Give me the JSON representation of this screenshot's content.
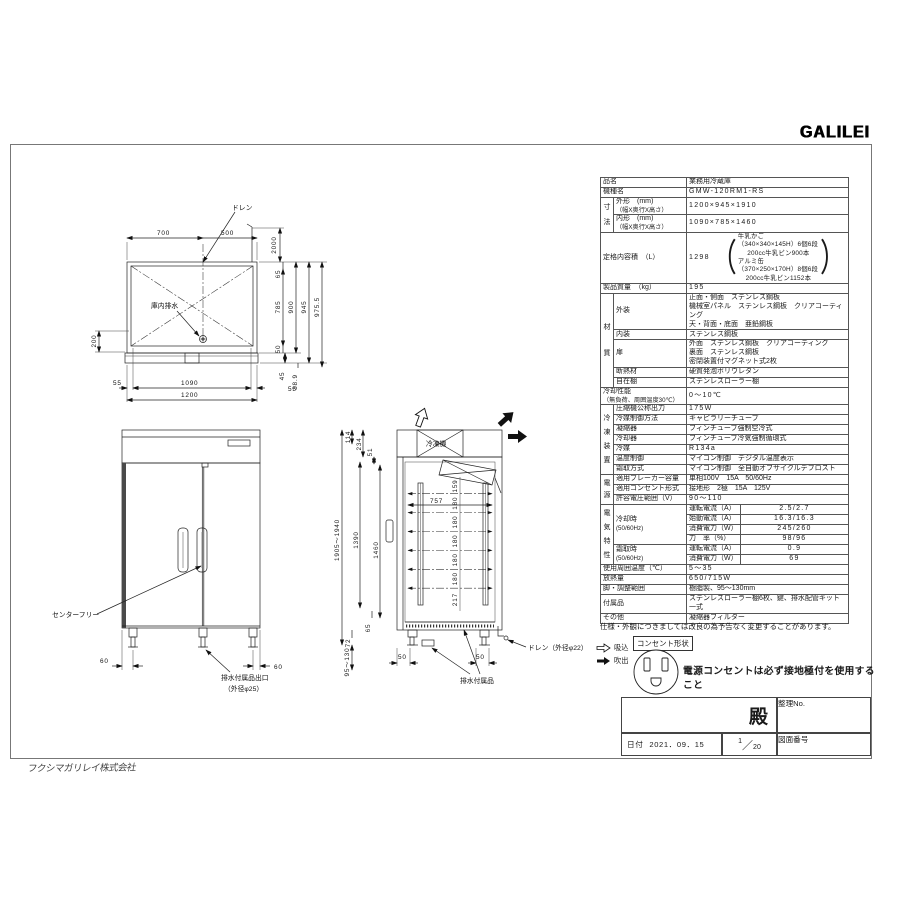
{
  "brand": {
    "logo": "GALILEI",
    "watermark": "フクシマガリレイ株式会社"
  },
  "spec": {
    "secs": {
      "sunpo": "寸\n法",
      "zai": "材\n質",
      "reito": "冷\n凍\n装\n置",
      "dengen": "電\n源",
      "denki": "電\n気\n特\n性"
    },
    "hinmei": {
      "l": "品名",
      "v": "業務用冷蔵庫"
    },
    "kishu": {
      "l": "機種名",
      "v": "GMW-120RM1-RS"
    },
    "gaikei": {
      "l": "外形　(mm)",
      "l2": "（幅X奥行X高さ）",
      "v": "1200×945×1910"
    },
    "naikei": {
      "l": "内形　(mm)",
      "l2": "（幅X奥行X高さ）",
      "v": "1090×785×1460"
    },
    "naiyoseki": {
      "l": "定格内容積　（L）",
      "v": "1298",
      "n1": "牛乳かご（340×340×145H）6個6段",
      "n2": "200cc牛乳ビン900本",
      "n3": "アルミ缶（370×250×170H）8個6段",
      "n4": "200cc牛乳ビン1152本"
    },
    "mass": {
      "l": "製品質量　（kg）",
      "v": "195"
    },
    "gaiso": {
      "l": "外装",
      "v1": "正面・側面　ステンレス鋼板",
      "v2": "機械室パネル　ステンレス鋼板　クリアコーティング",
      "v3": "天・背面・底面　亜鉛鋼板"
    },
    "naiso": {
      "l": "内装",
      "v": "ステンレス鋼板"
    },
    "tobira": {
      "l": "扉",
      "v1": "外面　ステンレス鋼板　クリアコーティング",
      "v2": "裏面　ステンレス鋼板",
      "v3": "密閉装置付マグネット式2枚"
    },
    "dannetsu": {
      "l": "断熱材",
      "v": "硬質発泡ポリウレタン"
    },
    "jizai": {
      "l": "自在棚",
      "v": "ステンレスローラー棚"
    },
    "reikyaku": {
      "l": "冷却性能",
      "l2": "（無負荷、周囲温度30℃）",
      "v": "0～10℃"
    },
    "asshuku": {
      "l": "圧縮機公称出力",
      "v": "175W"
    },
    "reibaiseigyo": {
      "l": "冷媒制御方法",
      "v": "キャピラリーチューブ"
    },
    "gyoshuku": {
      "l": "凝縮器",
      "v": "フィンチューブ強制空冷式"
    },
    "reikyakuki": {
      "l": "冷却器",
      "v": "フィンチューブ冷気強制循環式"
    },
    "reibai": {
      "l": "冷媒",
      "v": "R134a"
    },
    "ondo": {
      "l": "温度制御",
      "v": "マイコン制御　デジタル温度表示"
    },
    "shimotori": {
      "l": "霜取方式",
      "v": "マイコン制御　全自動オフサイクルデフロスト"
    },
    "breaker": {
      "l": "適用ブレーカー容量",
      "v": "単相100V　15A　50/60Hz"
    },
    "outlet": {
      "l": "適用コンセント形式",
      "v": "接地形　2極　15A　125V"
    },
    "voltage": {
      "l": "許容電圧範囲（V）",
      "v": "90～110"
    },
    "cool": {
      "l": "冷却時",
      "l2": "(50/60Hz)"
    },
    "defrost": {
      "l": "霜取時",
      "l2": "(50/60Hz)"
    },
    "c1": {
      "l": "運転電流（A）",
      "v": "2.5/2.7"
    },
    "c2": {
      "l": "始動電流（A）",
      "v": "16.3/16.3"
    },
    "c3": {
      "l": "消費電力（W）",
      "v": "245/260"
    },
    "c4": {
      "l": "力　率（%）",
      "v": "98/96"
    },
    "d1": {
      "l": "運転電流（A）",
      "v": "0.9"
    },
    "d2": {
      "l": "消費電力（W）",
      "v": "69"
    },
    "shuui": {
      "l": "使用周囲温度（℃）",
      "v": "5～35"
    },
    "hounetsu": {
      "l": "放熱量",
      "v": "650/715W"
    },
    "ashi": {
      "l": "脚・調整範囲",
      "v": "樹脂製、95～130mm"
    },
    "fuzoku": {
      "l": "付属品",
      "v": "ステンレスローラー棚6枚、鍵、排水配管キット一式"
    },
    "sonota": {
      "l": "その他",
      "v": "凝縮器フィルター"
    }
  },
  "notes": {
    "disclaimer": "仕様・外観につきましては改良の為予告なく変更することがあります。",
    "outlet_shape": "コンセント形状",
    "warning": "電源コンセントは必ず接地極付を使用すること",
    "suction": "吸込",
    "blowout": "吹出"
  },
  "title_block": {
    "dono": "殿",
    "seiri": "整理No.",
    "date_label": "日付",
    "date": "2021．09．15",
    "scale_n": "1",
    "scale_d": "20",
    "zuban": "図面番号"
  },
  "top_view": {
    "drain": "ドレン",
    "inner_drain": "庫内排水",
    "d700": "700",
    "d500": "500",
    "d2000": "2000",
    "d65": "65",
    "d785": "785",
    "d50": "50",
    "d900": "900",
    "d945": "945",
    "d975": "975.5",
    "d200": "200",
    "d55l": "55",
    "d1090": "1090",
    "d55r": "55",
    "d1200": "1200",
    "d45": "45",
    "d389": "38.9"
  },
  "front_view": {
    "center_free": "センターフリー",
    "drain_outlet": "排水付属品出口",
    "drain_outlet2": "（外径φ25）",
    "d60l": "60",
    "d60r": "60"
  },
  "side_view": {
    "unit": "冷凍機",
    "drain": "ドレン（外径φ22）",
    "drain_acc": "排水付属品",
    "total": "1905～1940",
    "d114": "114",
    "d234": "234",
    "d51": "51",
    "d1390": "1390",
    "d1460": "1460",
    "d65": "65",
    "d72": "72",
    "d95130": "95～130",
    "d757": "757",
    "s1": "159",
    "s2": "180",
    "s3": "180",
    "s4": "180",
    "s5": "180",
    "s6": "180",
    "s7": "217",
    "d50f": "50",
    "d50r": "50"
  }
}
